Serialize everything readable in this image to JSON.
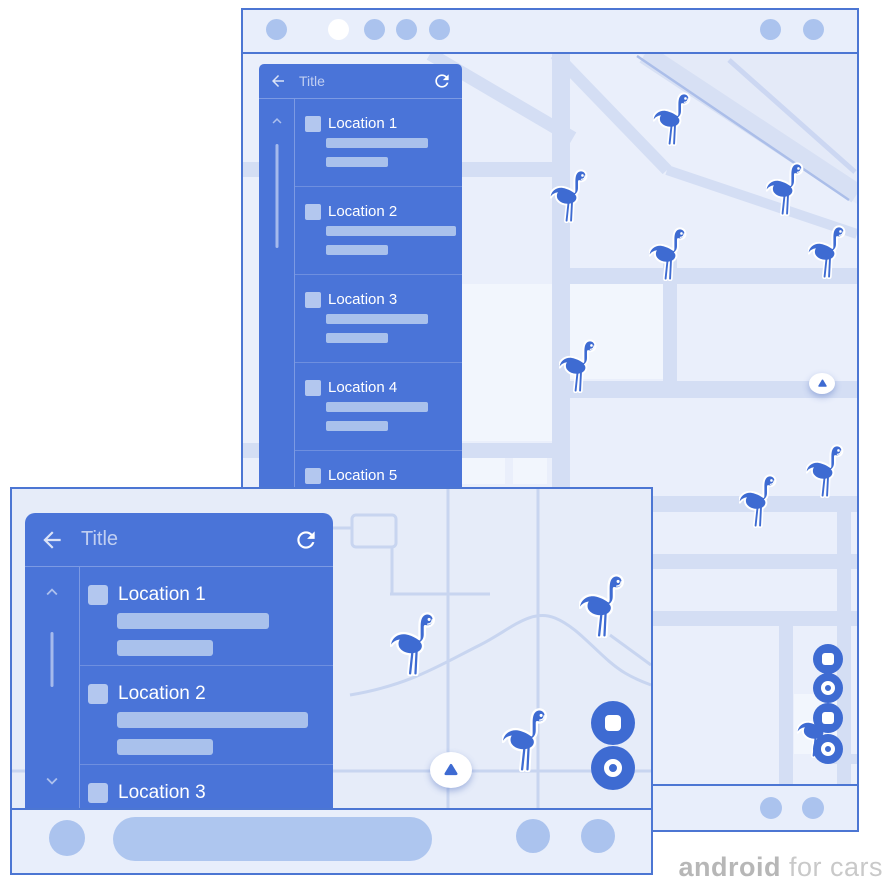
{
  "watermark": {
    "brand": "android",
    "suffix": " for cars"
  },
  "colors": {
    "panel_blue": "#4a74d8",
    "accent_blue": "#3e6bd2",
    "pale_blue": "#abc3ee",
    "frame_border": "#4c76d3",
    "map_bg_portrait": "#eaeffb",
    "map_bg_landscape": "#e6ecf9",
    "watermark_gray": "#bdbdbd"
  },
  "portrait_screen": {
    "panel": {
      "title": "Title",
      "items": [
        {
          "label": "Location 1"
        },
        {
          "label": "Location 2"
        },
        {
          "label": "Location 3"
        },
        {
          "label": "Location 4"
        },
        {
          "label": "Location 5"
        }
      ]
    }
  },
  "landscape_screen": {
    "panel": {
      "title": "Title",
      "items": [
        {
          "label": "Location 1"
        },
        {
          "label": "Location 2"
        },
        {
          "label": "Location 3"
        }
      ]
    }
  }
}
